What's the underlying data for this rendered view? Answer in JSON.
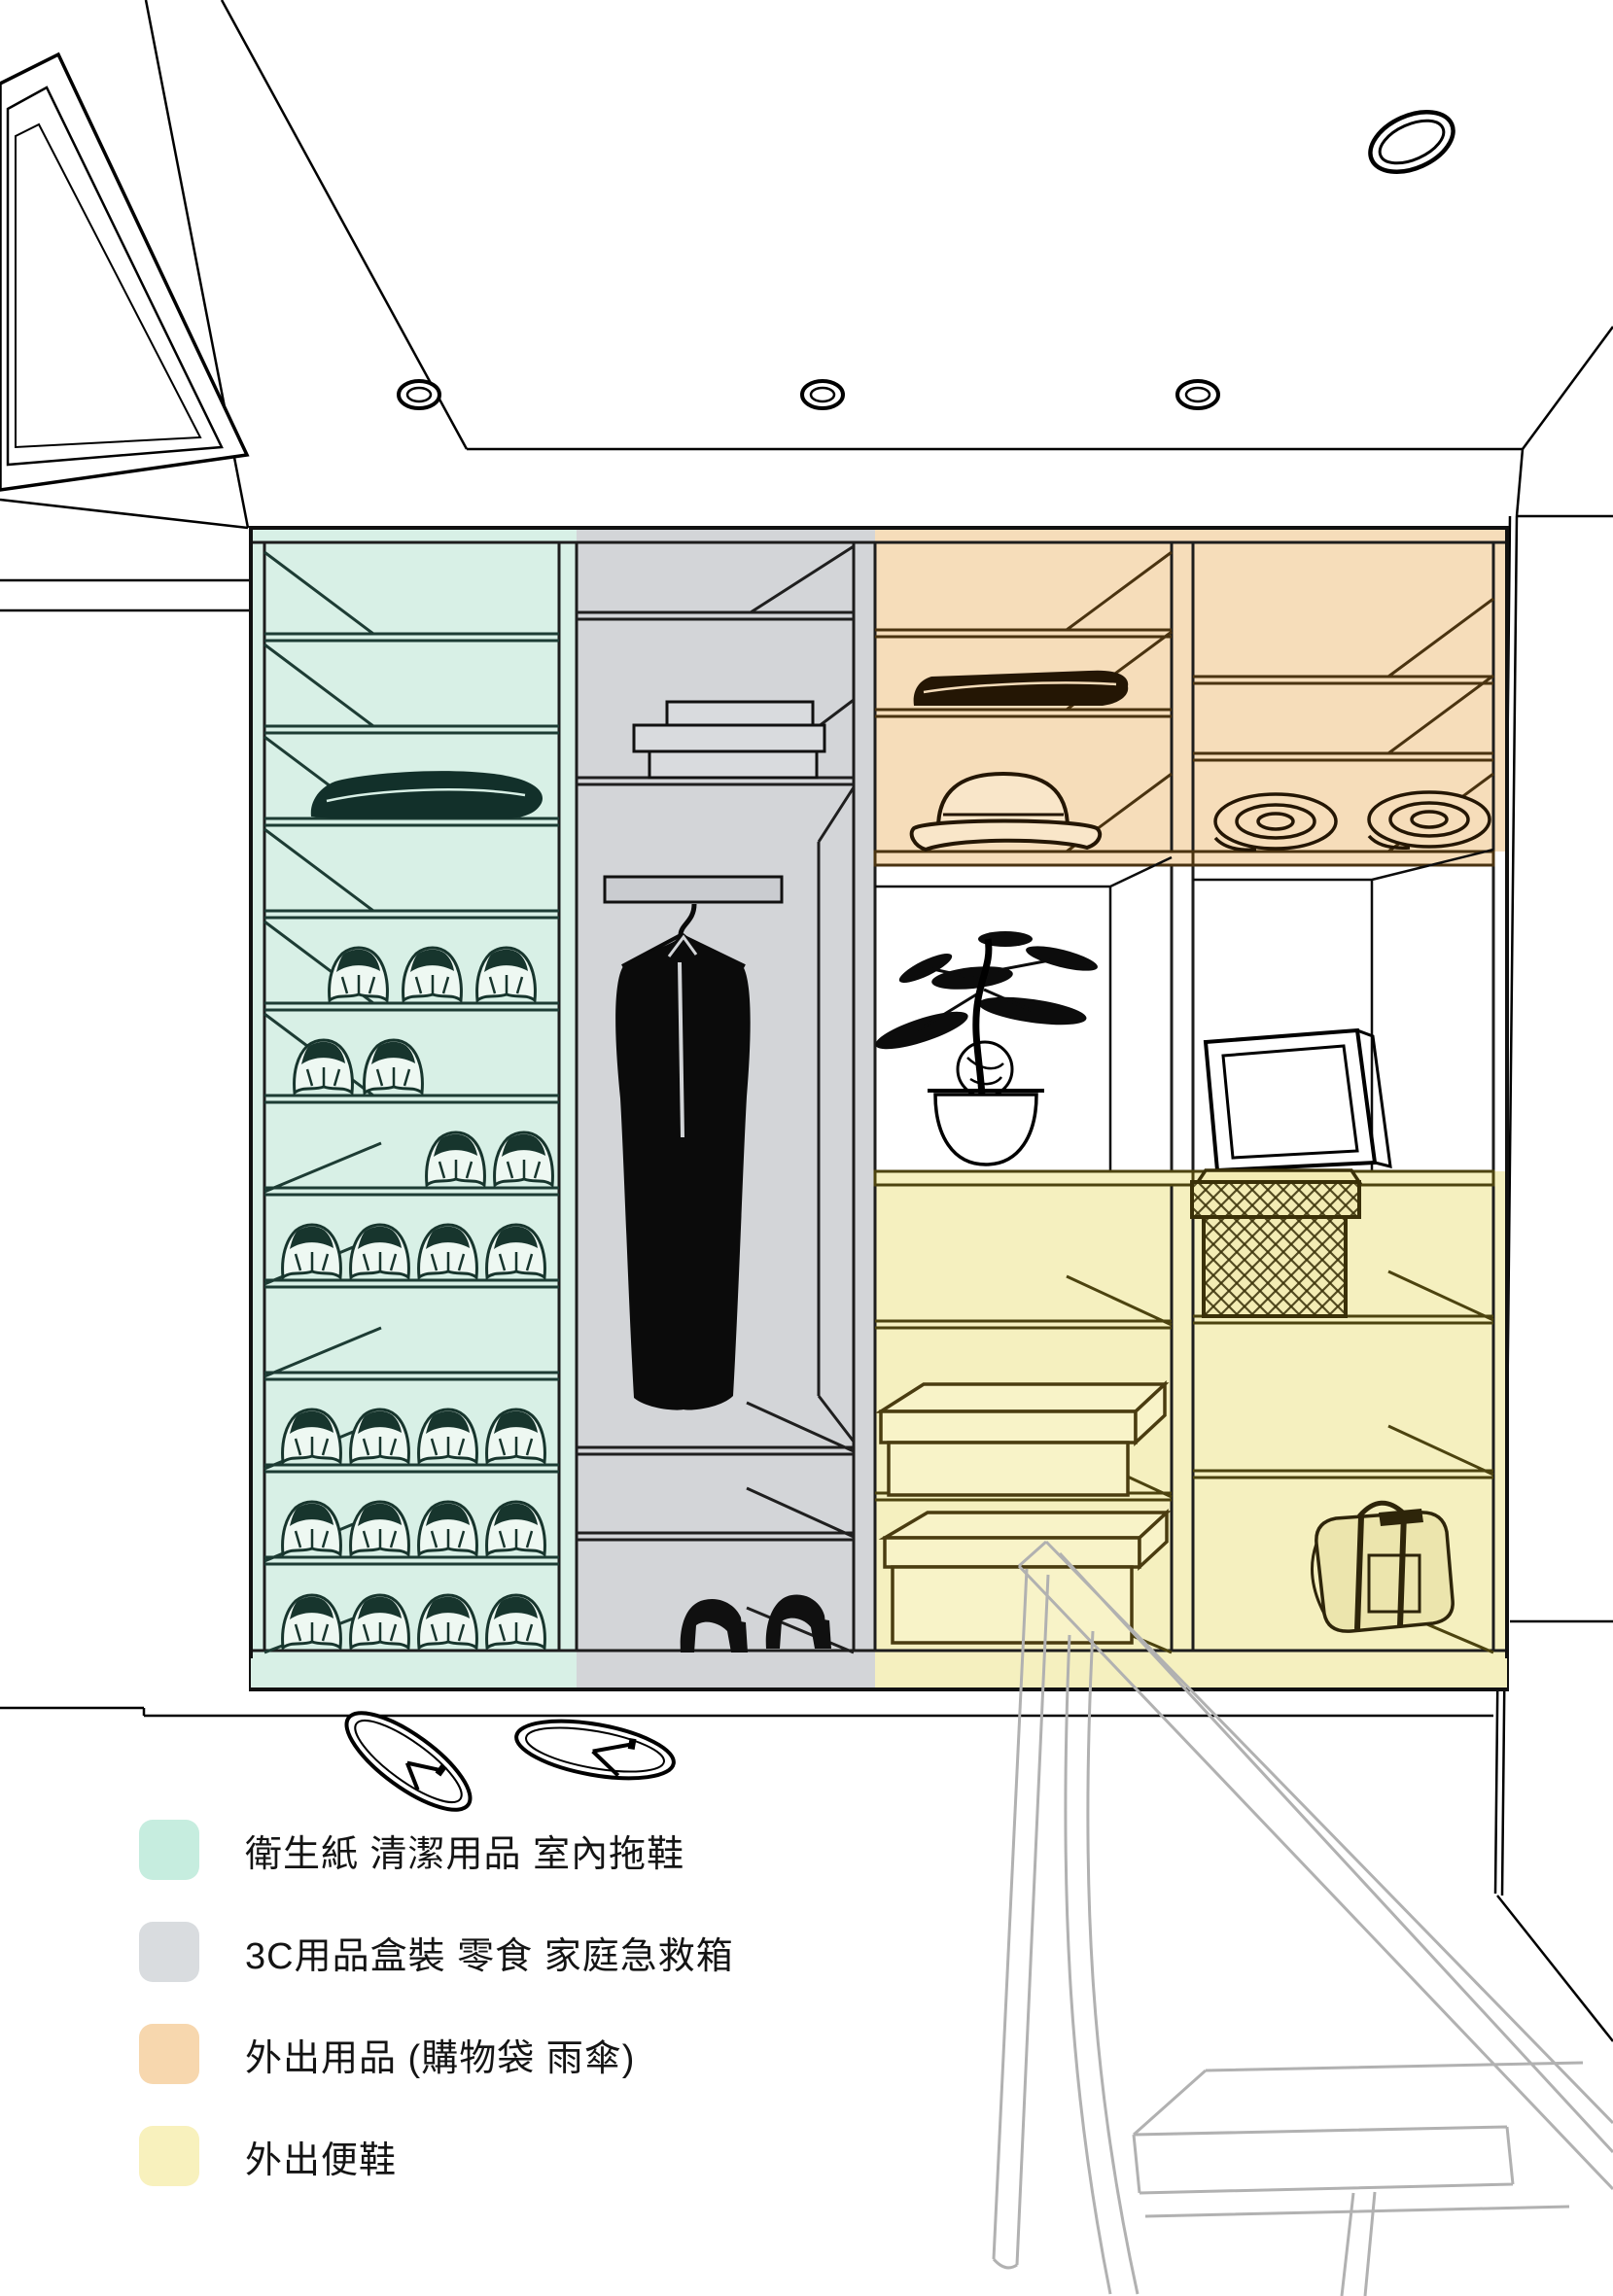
{
  "legend": {
    "items": [
      {
        "id": "mint",
        "color": "#c6eddf",
        "label": "衛生紙 清潔用品 室內拖鞋"
      },
      {
        "id": "gray",
        "color": "#d9dcdf",
        "label": "3C用品盒裝 零食 家庭急救箱"
      },
      {
        "id": "orange",
        "color": "#f7d7ae",
        "label": "外出用品 (購物袋 雨傘)"
      },
      {
        "id": "yellow",
        "color": "#f8f1bd",
        "label": "外出便鞋"
      }
    ]
  },
  "zones": {
    "mint": {
      "color": "#d8f0e6",
      "label": "衛生紙 清潔用品 室內拖鞋"
    },
    "gray": {
      "color": "#d3d5d8",
      "label": "3C用品盒裝 零食 家庭急救箱"
    },
    "orange": {
      "color": "#f6ddba",
      "label": "外出用品 (購物袋 雨傘)"
    },
    "yellow": {
      "color": "#f5f0bf",
      "label": "外出便鞋"
    },
    "niche": {
      "color": "#ffffff",
      "label": "display niche"
    }
  },
  "closet": {
    "sections": [
      {
        "id": "section-1",
        "zone": "mint",
        "contents": [
          "empty shelf",
          "empty shelf",
          "folded cloth",
          "empty shelf",
          "3 slippers",
          "2 slippers",
          "2 slippers",
          "4 slippers",
          "empty shelf",
          "4 slippers",
          "4 slippers",
          "4 slippers"
        ]
      },
      {
        "id": "section-2",
        "zone": "gray",
        "contents": [
          "empty shelf",
          "stacked flat boxes",
          "hanger rod with long coat",
          "empty shelf",
          "empty shelf",
          "pair of high heels"
        ]
      },
      {
        "id": "section-3",
        "zone": "orange / niche / yellow",
        "contents": [
          "empty shelf",
          "folded towels",
          "hat",
          "bonsai plant in pot",
          "empty shelf",
          "shoe box",
          "shoe box"
        ]
      },
      {
        "id": "section-4",
        "zone": "orange / niche / yellow",
        "contents": [
          "empty shelf",
          "empty shelf",
          "2 rolled towels",
          "picture frame",
          "woven lidded basket",
          "empty shelf",
          "duffel bag"
        ]
      }
    ]
  },
  "ceiling": {
    "recessed_lights_small": 3,
    "recessed_light_large": 1,
    "ac_vent": true
  },
  "floor": {
    "items": [
      "pair of flip-flops"
    ]
  },
  "foreground": {
    "items": [
      "translucent tall table outline",
      "translucent stool outline"
    ]
  }
}
